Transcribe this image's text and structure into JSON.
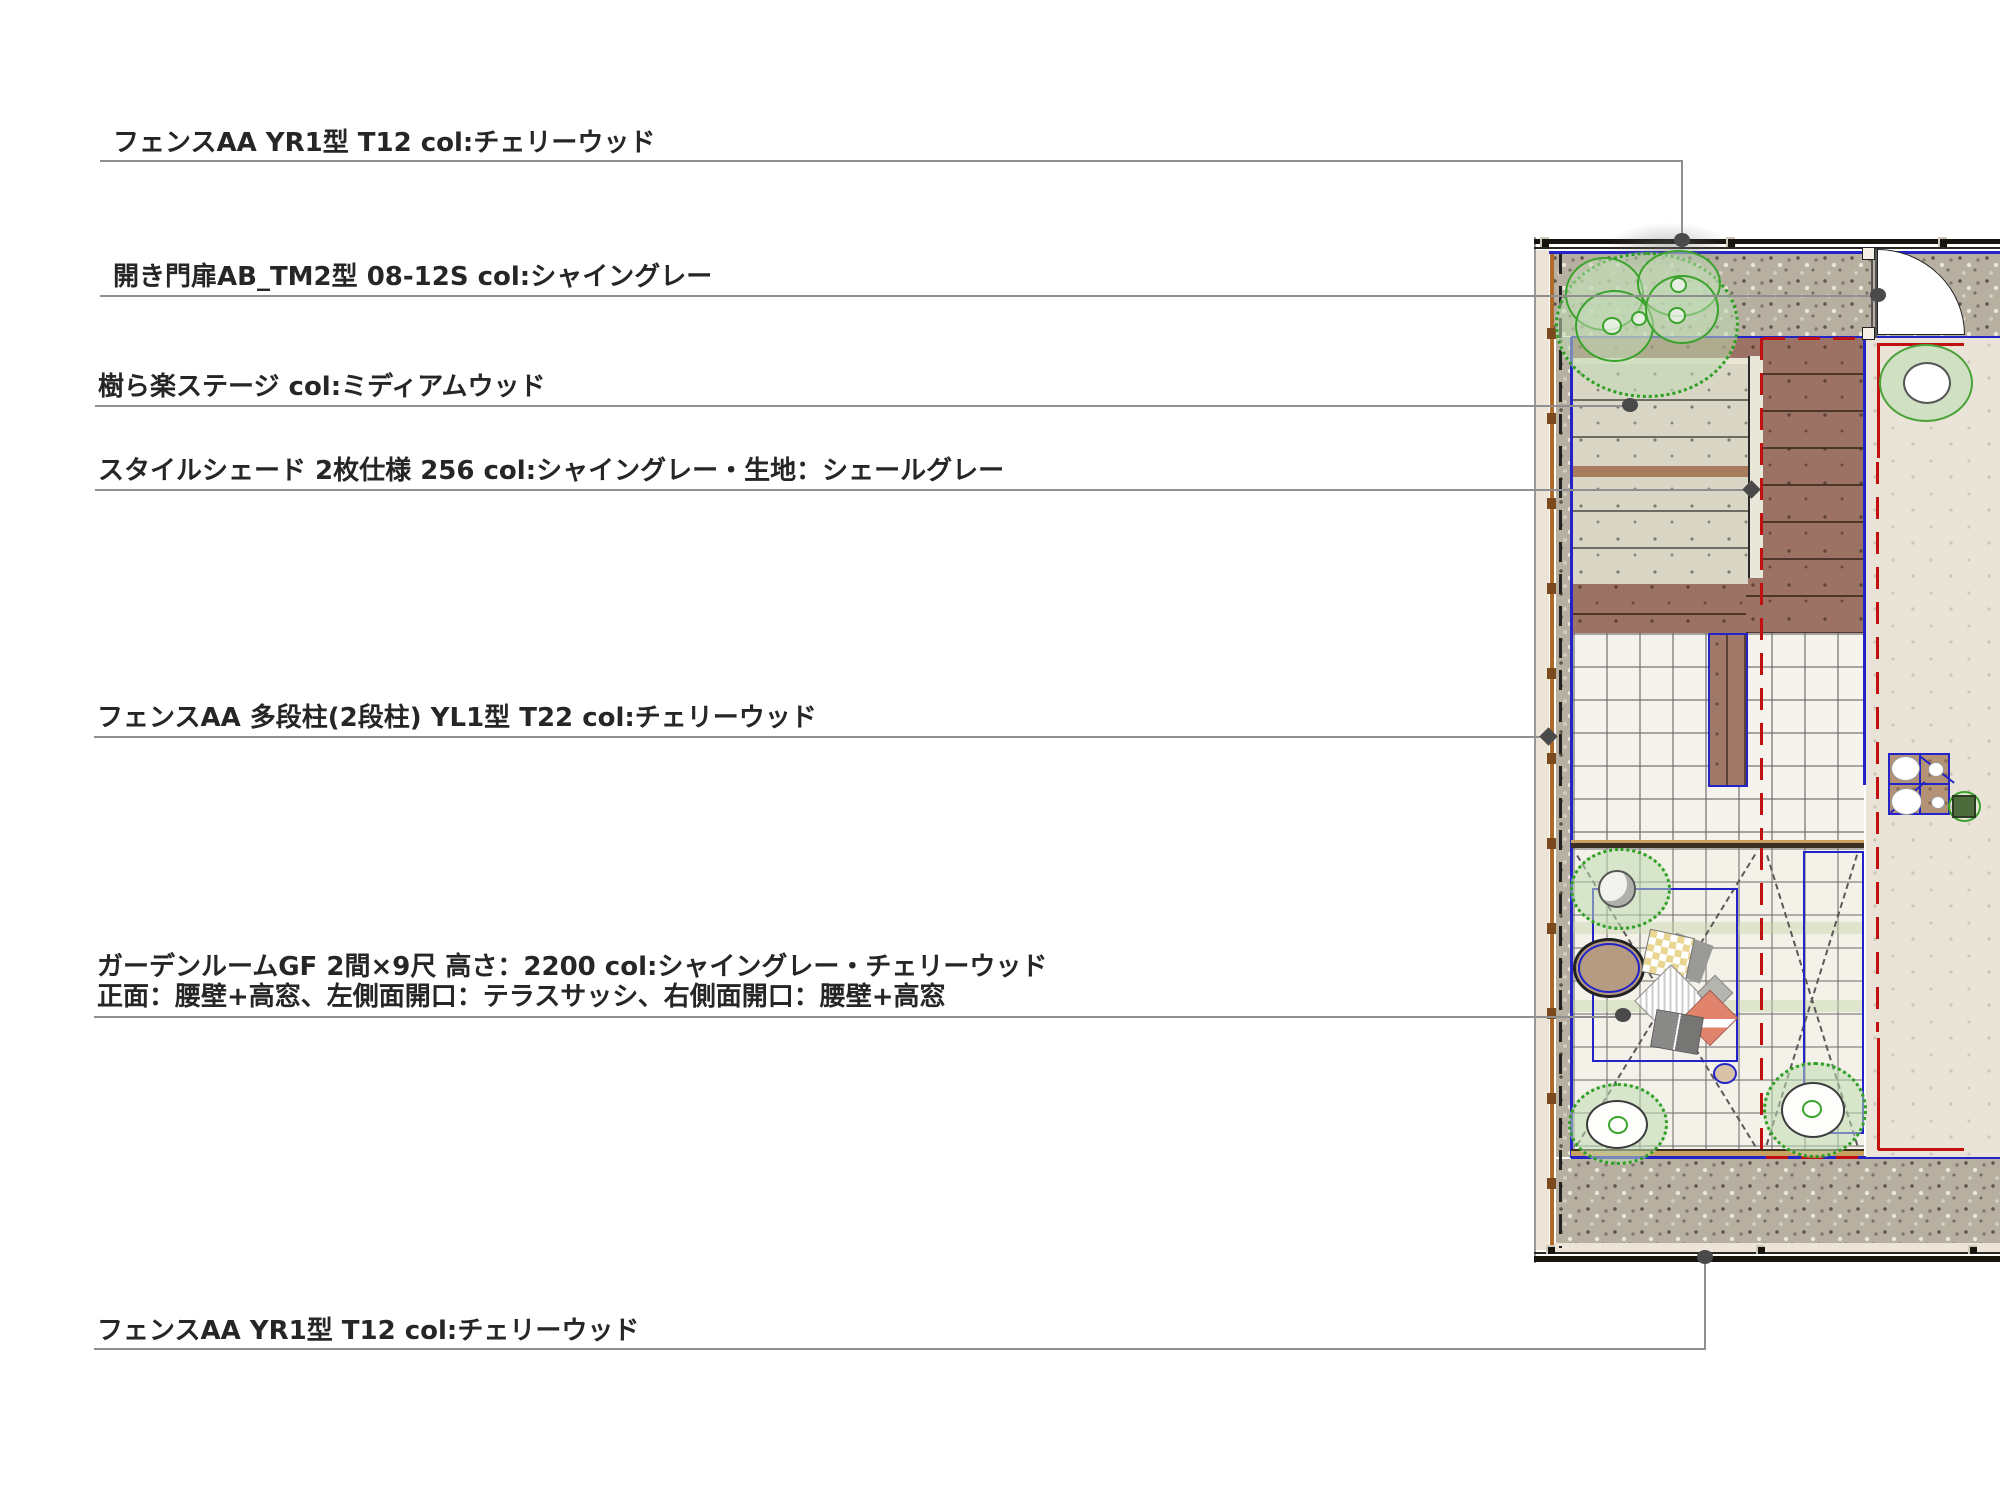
{
  "callouts": [
    {
      "id": "fence-top",
      "text": "フェンスAA YR1型 T12 col:チェリーウッド"
    },
    {
      "id": "gate",
      "text": "開き門扉AB_TM2型 08-12S col:シャイングレー"
    },
    {
      "id": "deck",
      "text": "樹ら楽ステージ col:ミディアムウッド"
    },
    {
      "id": "shade",
      "text": "スタイルシェード 2枚仕様 256 col:シャイングレー・生地：シェールグレー"
    },
    {
      "id": "fence-multi",
      "text": "フェンスAA 多段柱(2段柱) YL1型 T22 col:チェリーウッド"
    },
    {
      "id": "garden-room",
      "text": "ガーデンルームGF 2間×9尺 高さ：2200 col:シャイングレー・チェリーウッド",
      "text2": "正面：腰壁+高窓、左側面開口：テラスサッシ、右側面開口：腰壁+高窓"
    },
    {
      "id": "fence-bottom",
      "text": "フェンスAA YR1型 T12 col:チェリーウッド"
    }
  ],
  "plan_colors": {
    "site_border_blue": "#2323c8",
    "center_line_red": "#c01010",
    "deck_brown": "#9b7263",
    "shade_fabric_grey": "#d9d6c6",
    "tree_green": "#3aa32c",
    "gravel_grey": "#b7b0a1",
    "house_floor_cream": "#e9e3d8",
    "fence_dark": "#17140e",
    "fence_post_orange": "#b06a28"
  }
}
